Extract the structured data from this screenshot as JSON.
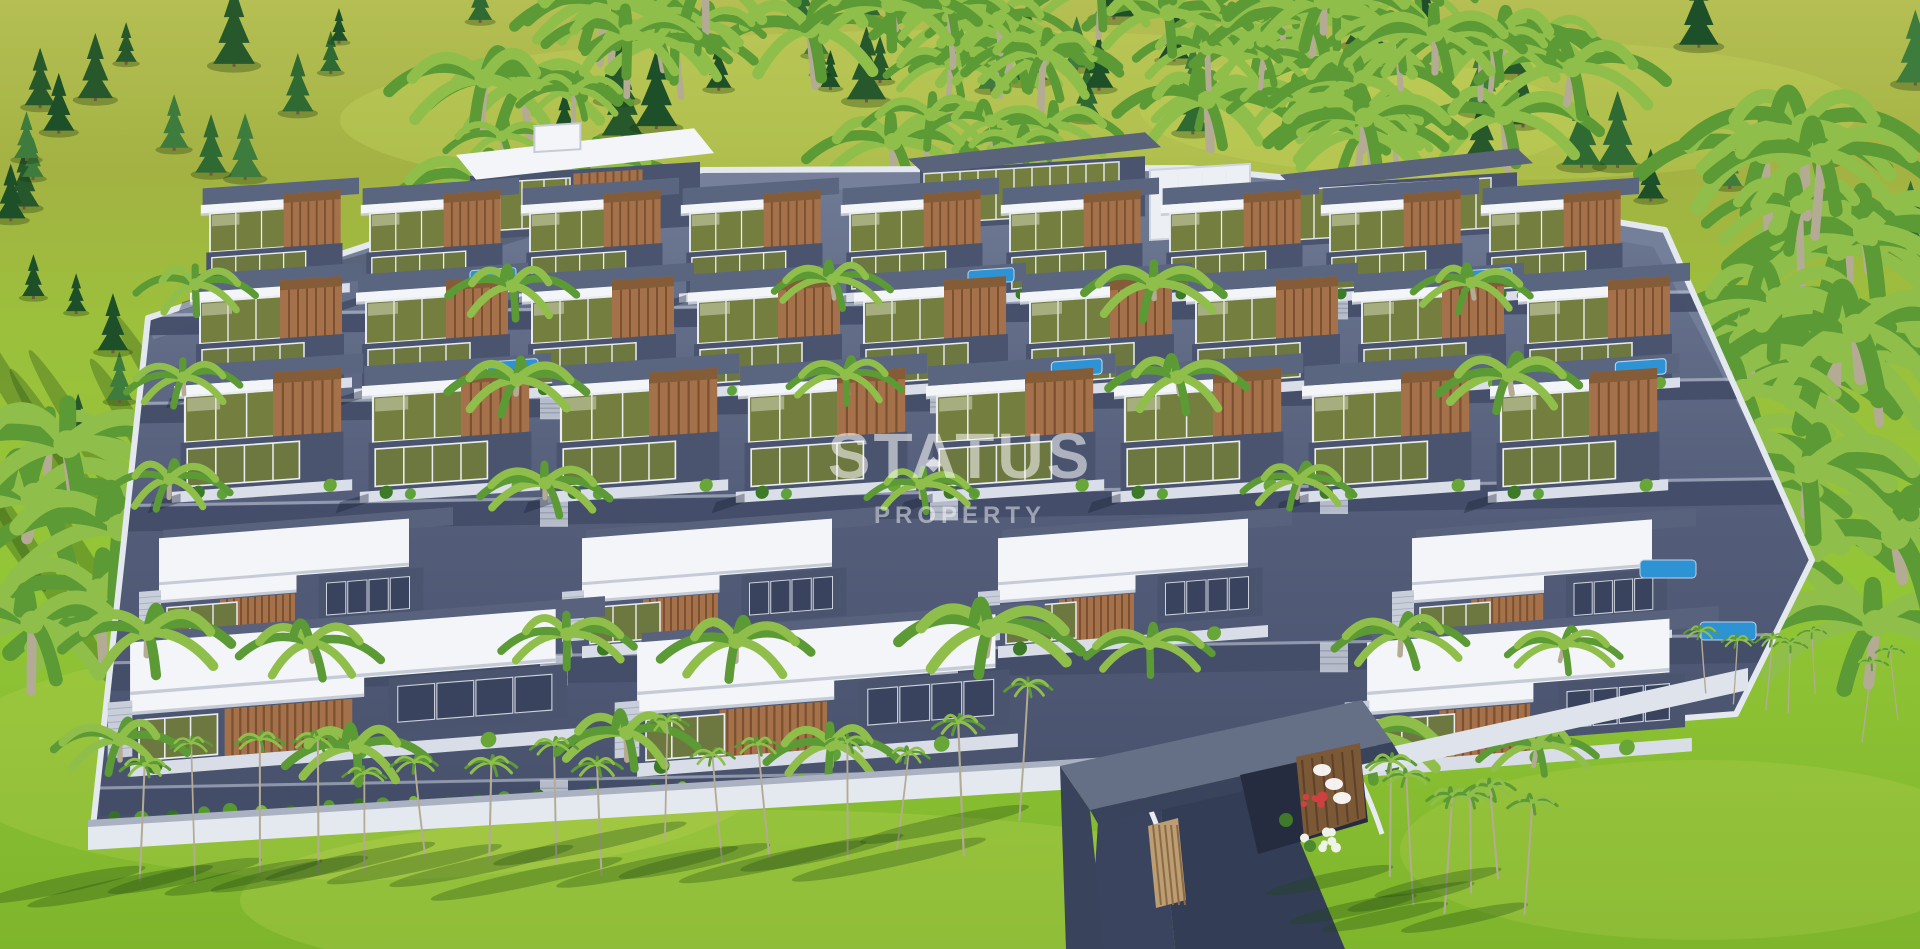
{
  "watermark": {
    "line1": "STATUS",
    "line2": "PROPERTY",
    "logo_star_icon": "4-point-star"
  },
  "palette": {
    "grass_top": "#aab545",
    "grass_mid": "#9cc03c",
    "grass_bottom": "#84ba2e",
    "grass_light": "#c7d65e",
    "shadow_green": "rgba(30,70,15,0.30)",
    "pine_dark": "#1d4f28",
    "pine_mid": "#2f6a33",
    "pine_light": "#3d7c3c",
    "palm_green": "#5c9a35",
    "palm_light": "#8fbf4a",
    "trunk": "#b4ab94",
    "compound_top": "#717c96",
    "compound_mid": "#525c78",
    "compound_dark": "#47506b",
    "road": "#434d68",
    "asphalt": "#333d56",
    "wall_white": "#e4e8ef",
    "roof_white": "#f3f5f8",
    "roof_edge": "#c6ccd7",
    "roof_slate": "#59637a",
    "slate_body": "#4a546f",
    "wood": "#a4714a",
    "wood_dark": "#7b512f",
    "wood_top": "#855c38",
    "glass_olive": "#747e3f",
    "glass_dark": "#3a435e",
    "pool_blue": "#2e93d4",
    "frame_white": "#e9ecf1",
    "stair_gray": "#c9cfda",
    "flower_red": "#cf4040",
    "flower_white": "#eef2e8",
    "gate_slate": "#656f85",
    "gate_dark": "#39435c"
  },
  "vegetation": {
    "conifers_top": 48,
    "palms_top": 58,
    "pines_left": 9,
    "palms_left": 7,
    "palms_right": 24,
    "palms_bottom": 16,
    "palms_gate_cluster": 6,
    "palms_far_right": 5,
    "hedge_shrubs": 34
  },
  "buildings": {
    "top_row": [
      {
        "type": "corner",
        "x": 320,
        "y": 240,
        "w": 210
      },
      {
        "type": "white",
        "x": 470,
        "y": 150,
        "w": 230
      },
      {
        "type": "gray",
        "x": 920,
        "y": 152,
        "w": 225
      },
      {
        "type": "whitebox",
        "x": 1150,
        "y": 162,
        "w": 100
      },
      {
        "type": "gray",
        "x": 1292,
        "y": 168,
        "w": 225
      }
    ],
    "small_rows": [
      {
        "y": 210,
        "x0": 210,
        "dx": 160,
        "count": 9,
        "s": 0.92
      },
      {
        "y": 298,
        "x0": 200,
        "dx": 166,
        "count": 9,
        "s": 1.0
      },
      {
        "y": 392,
        "x0": 185,
        "dx": 188,
        "count": 8,
        "s": 1.1
      }
    ],
    "large_rows": [
      {
        "y": 545,
        "s": 1.0,
        "villas": [
          {
            "x": 175,
            "w": 250
          },
          {
            "x": 598,
            "w": 250
          },
          {
            "x": 1014,
            "w": 250
          },
          {
            "x": 1428,
            "w": 240
          }
        ]
      },
      {
        "y": 650,
        "s": 1.12,
        "villas": [
          {
            "x": 148,
            "w": 380
          },
          {
            "x": 655,
            "w": 320
          },
          {
            "x": 1385,
            "w": 270
          }
        ]
      }
    ],
    "extra_pools": [
      [
        1640,
        560
      ],
      [
        1700,
        622
      ]
    ]
  }
}
